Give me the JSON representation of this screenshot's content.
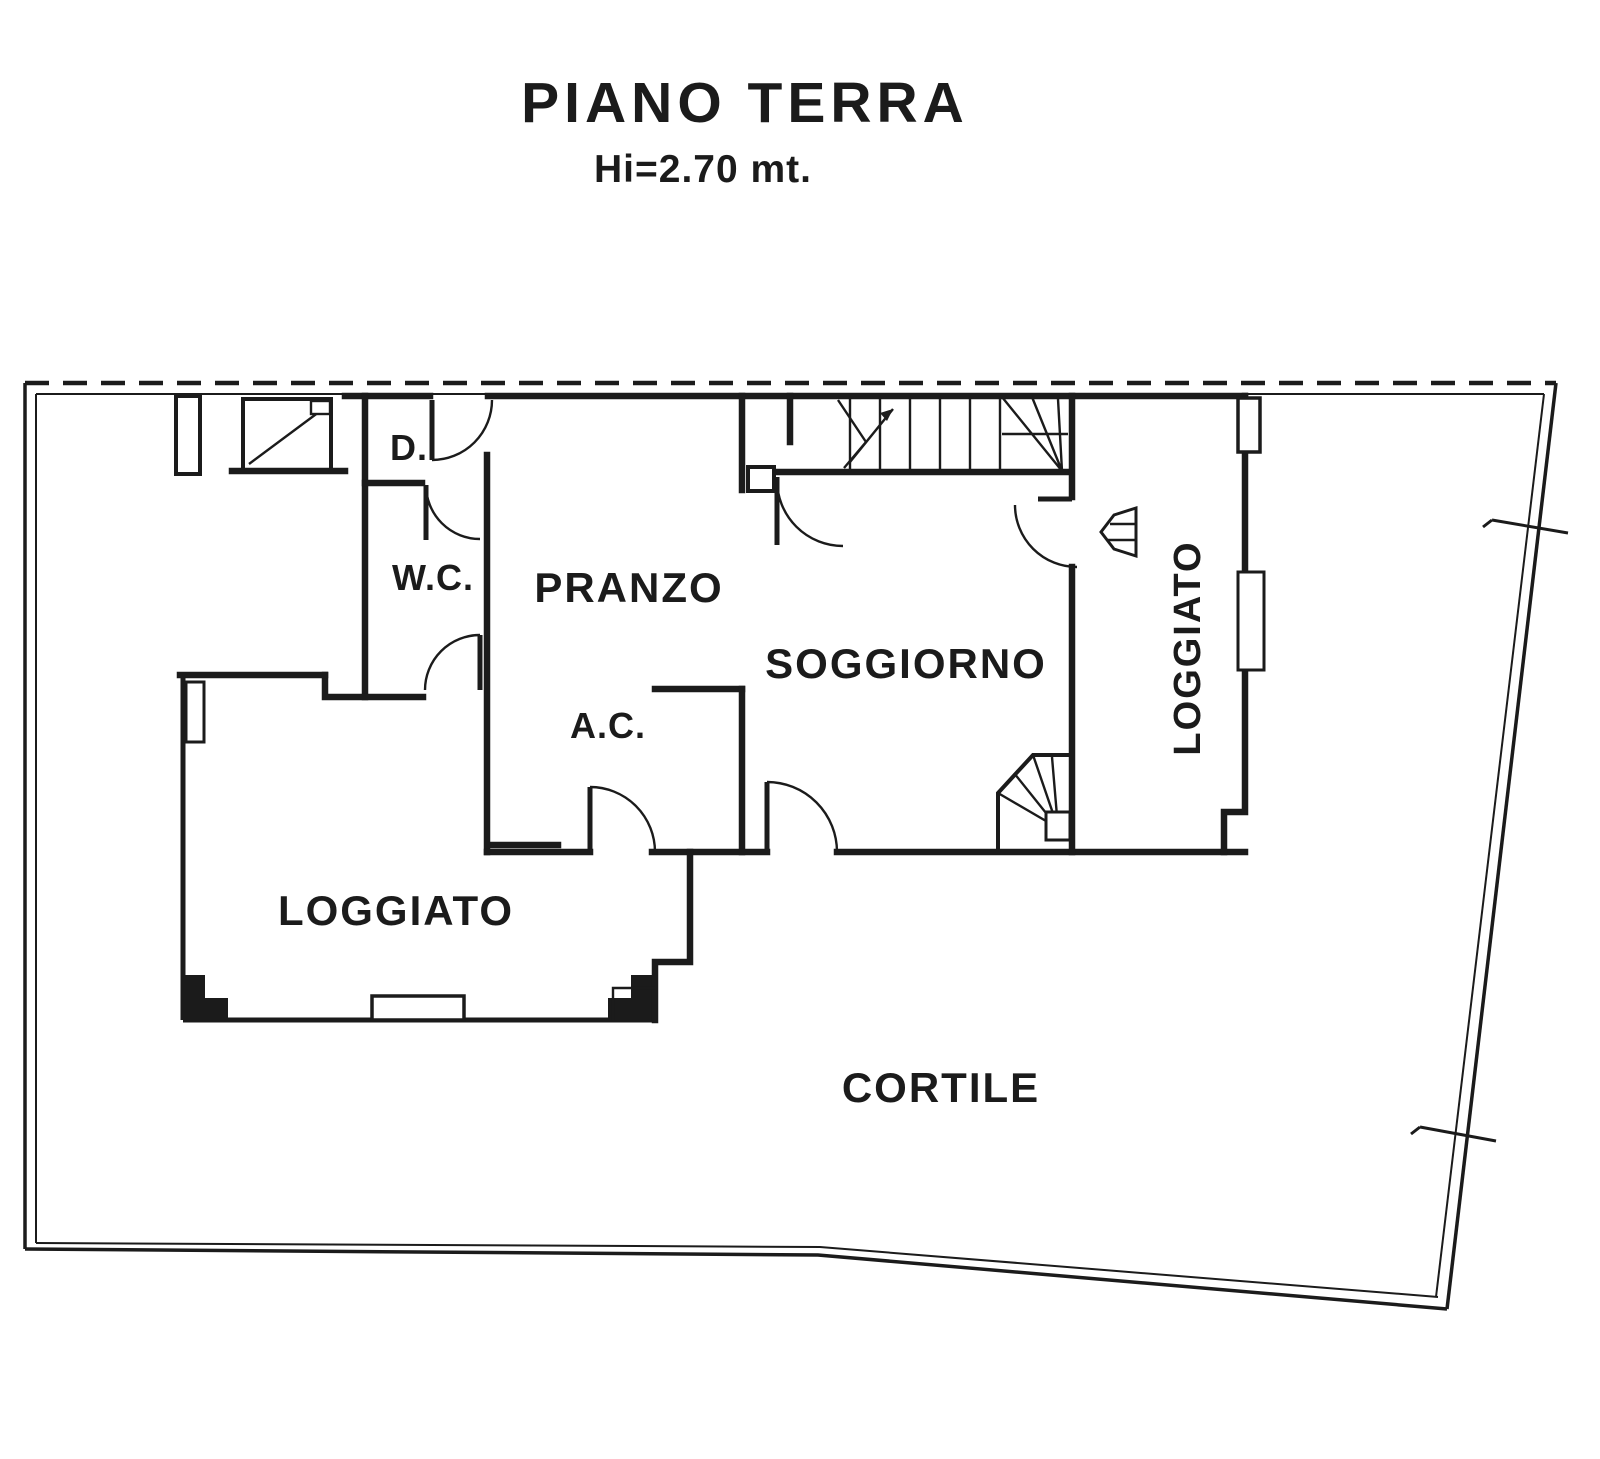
{
  "document": {
    "title": "PIANO TERRA",
    "subtitle": "Hi=2.70 mt."
  },
  "rooms": {
    "d": "D.",
    "wc": "W.C.",
    "pranzo": "PRANZO",
    "ac": "A.C.",
    "soggiorno": "SOGGIORNO",
    "loggiato_right": "LOGGIATO",
    "loggiato_left": "LOGGIATO",
    "cortile": "CORTILE"
  },
  "colors": {
    "ink": "#1b1b1b",
    "paper": "#ffffff"
  }
}
